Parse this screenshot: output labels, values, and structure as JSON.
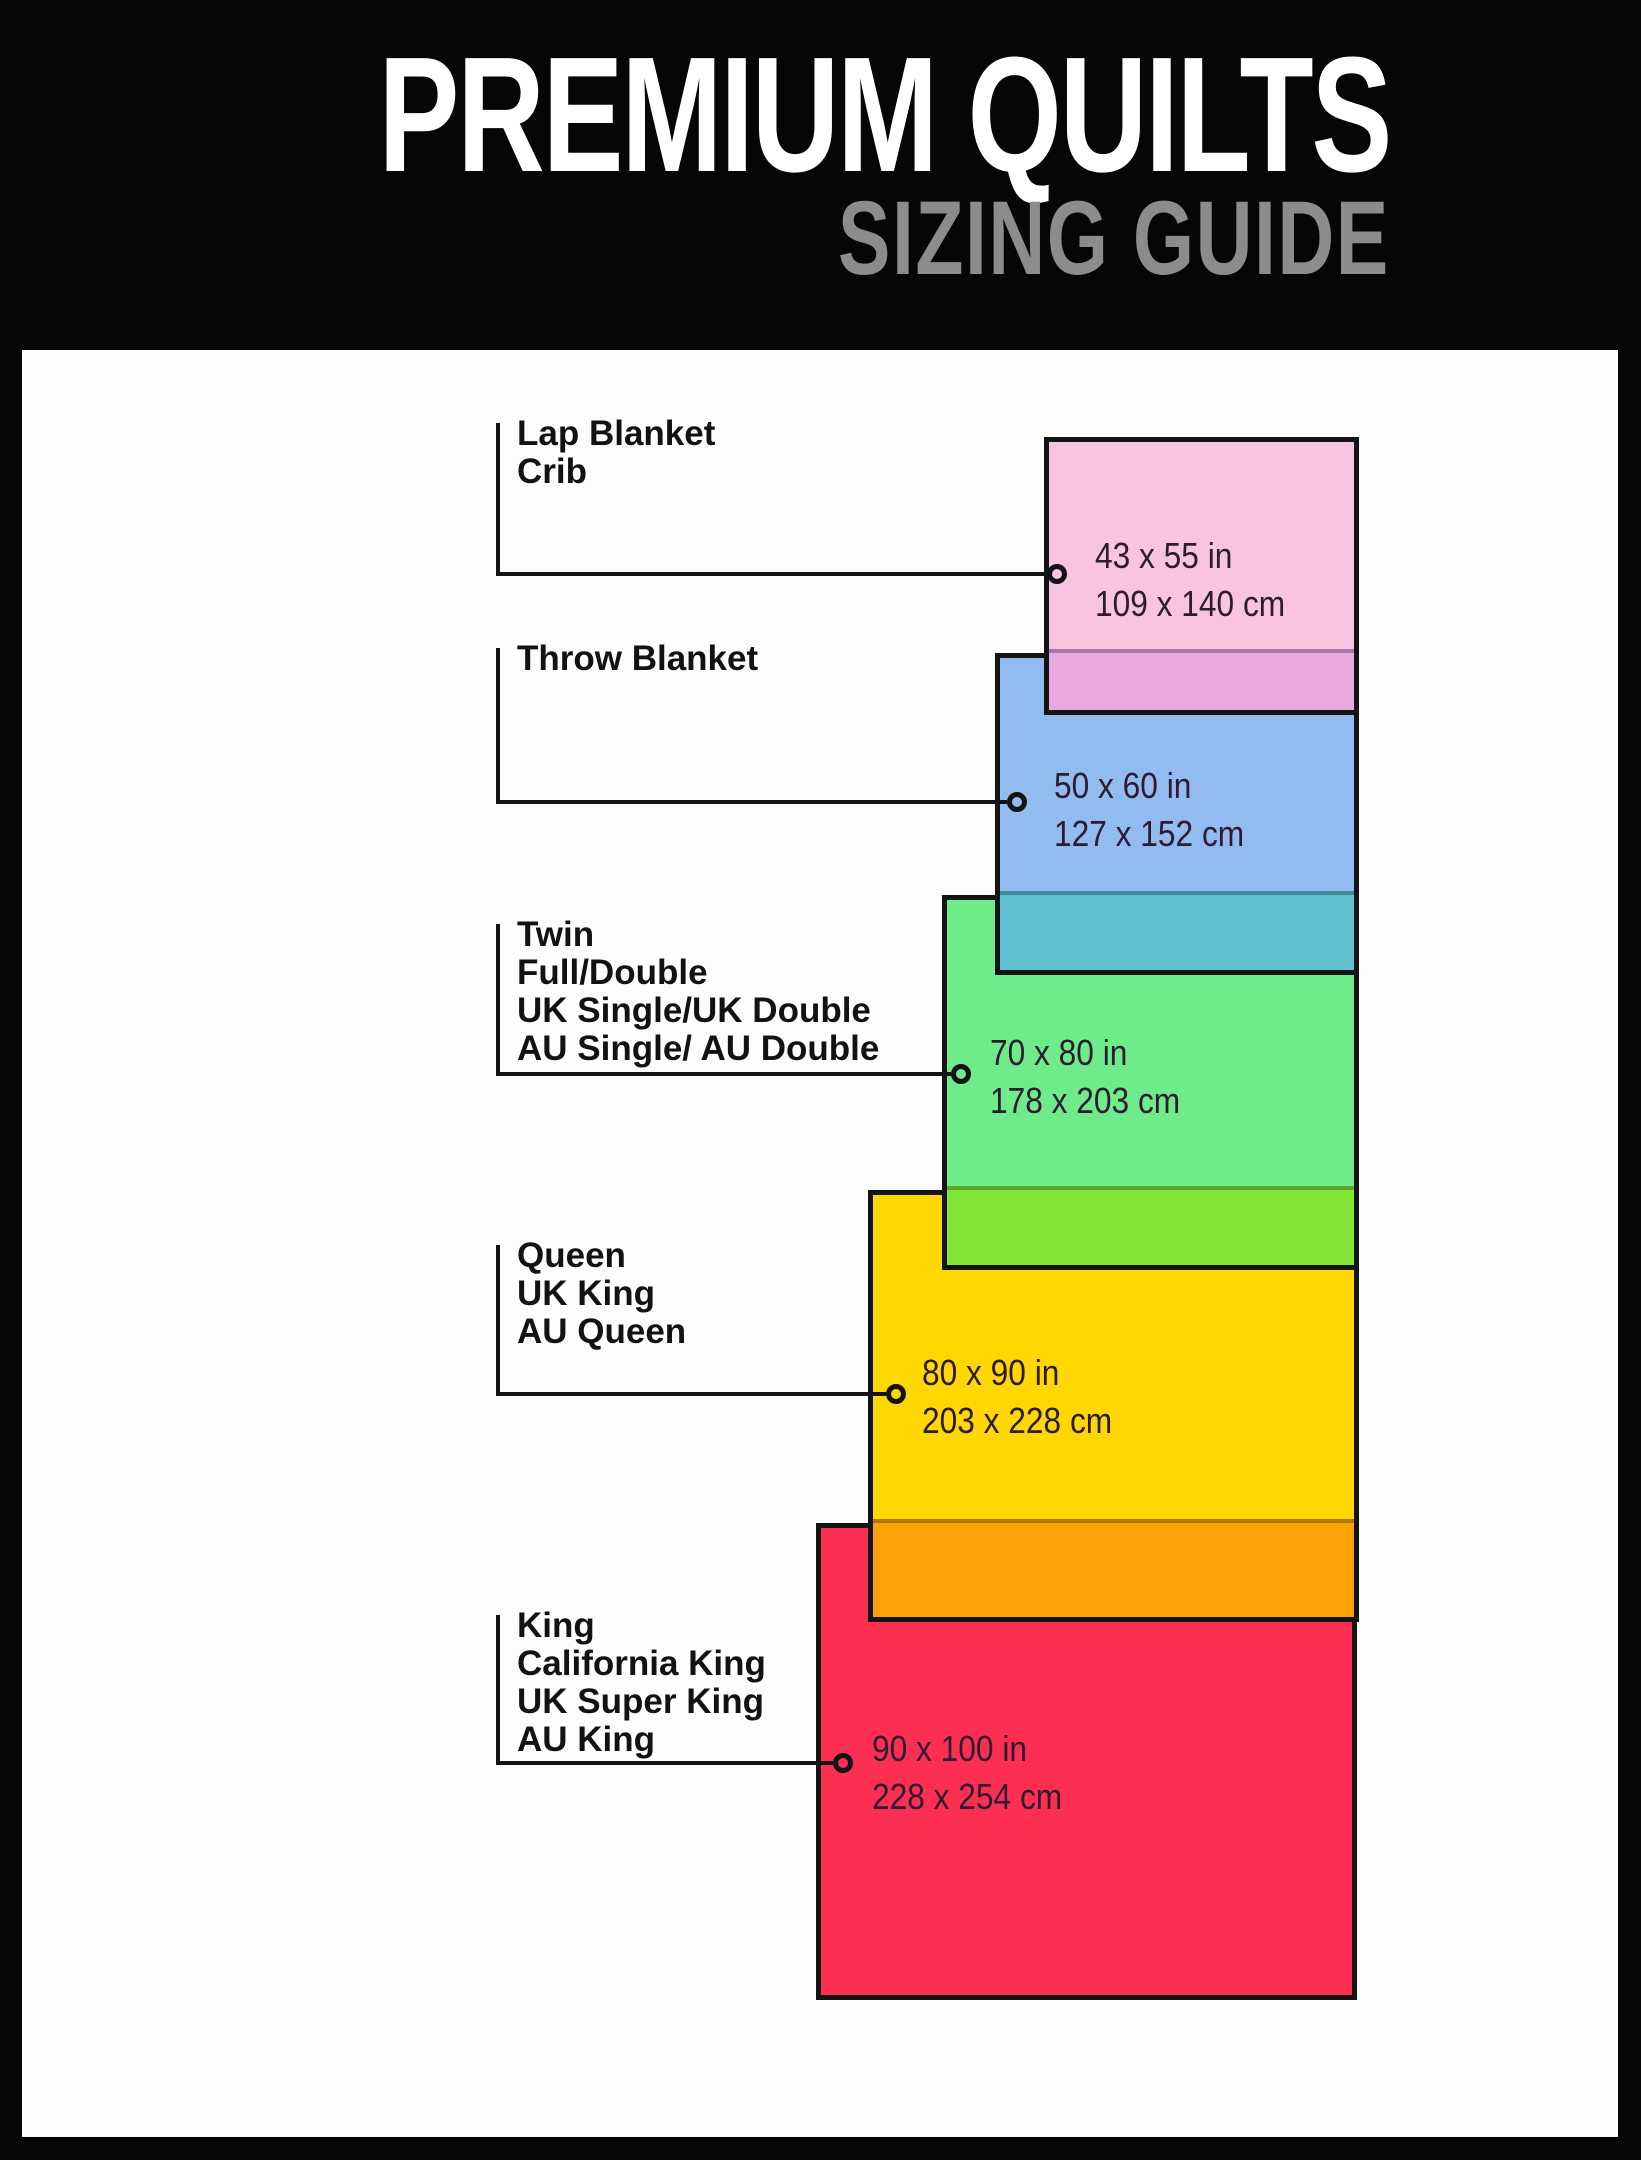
{
  "header": {
    "title": "PREMIUM QUILTS",
    "subtitle": "SIZING GUIDE"
  },
  "palette": {
    "page_background": "#060606",
    "content_background": "#fdfdfd",
    "title_color": "#ffffff",
    "subtitle_color": "#8c8c8c",
    "line_color": "#141414"
  },
  "sizes": [
    {
      "key": "lap-blanket-crib",
      "names": [
        "Lap Blanket",
        "Crib"
      ],
      "inches": "43 x 55 in",
      "cm": "109 x 140 cm",
      "fill": "#f9c4e1",
      "overlap_fill": "#e8aade"
    },
    {
      "key": "throw-blanket",
      "names": [
        "Throw Blanket"
      ],
      "inches": "50 x 60 in",
      "cm": "127 x 152 cm",
      "fill": "#92bbf0",
      "overlap_fill": "#5fc0d0"
    },
    {
      "key": "twin-full-double",
      "names": [
        "Twin",
        "Full/Double",
        "UK Single/UK Double",
        "AU Single/ AU Double"
      ],
      "inches": "70 x 80 in",
      "cm": "178 x 203 cm",
      "fill": "#6eeb8b",
      "overlap_fill": "#83e636"
    },
    {
      "key": "queen-uk-king-au-queen",
      "names": [
        "Queen",
        "UK King",
        "AU Queen"
      ],
      "inches": "80 x 90 in",
      "cm": "203 x 228 cm",
      "fill": "#ffd703",
      "overlap_fill": "#fba206"
    },
    {
      "key": "king-california-king",
      "names": [
        "King",
        "California King",
        "UK Super King",
        "AU King"
      ],
      "inches": "90 x 100 in",
      "cm": "228 x 254 cm",
      "fill": "#fc2e52",
      "overlap_fill": null
    }
  ]
}
